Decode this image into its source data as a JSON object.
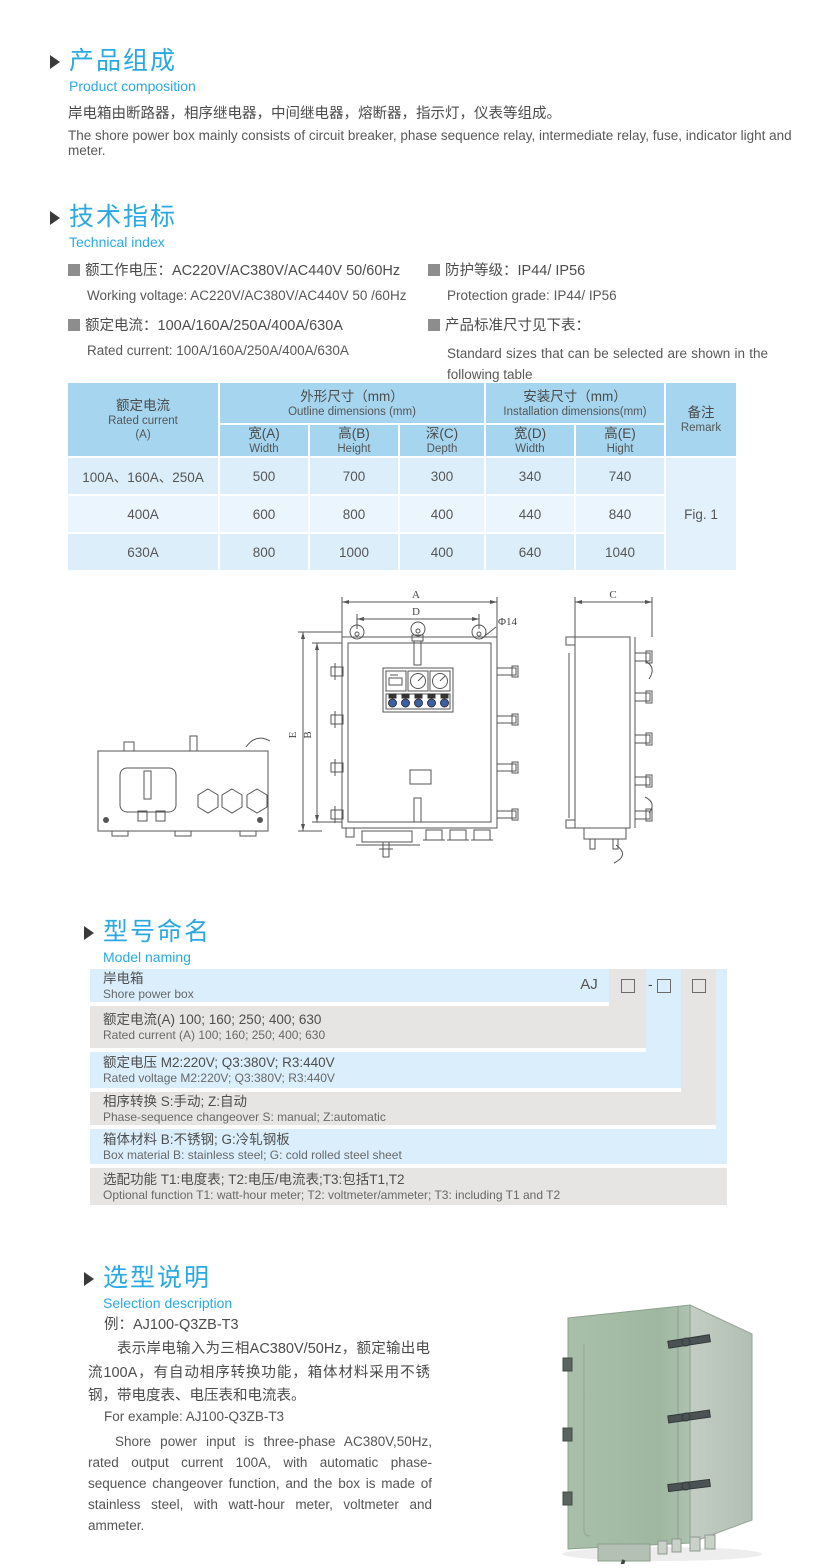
{
  "product_composition": {
    "heading_zh": "产品组成",
    "heading_en": "Product  composition",
    "body_zh": "岸电箱由断路器，相序继电器，中间继电器，熔断器，指示灯，仪表等组成。",
    "body_en": "The shore power box mainly consists of circuit breaker, phase sequence relay, intermediate relay, fuse, indicator light and meter."
  },
  "technical_index": {
    "heading_zh": "技术指标",
    "heading_en": "Technical index",
    "left_items": [
      {
        "zh": "额工作电压：AC220V/AC380V/AC440V  50/60Hz",
        "en": "Working voltage: AC220V/AC380V/AC440V 50 /60Hz"
      },
      {
        "zh": "额定电流：100A/160A/250A/400A/630A",
        "en": "Rated current: 100A/160A/250A/400A/630A"
      }
    ],
    "right_items": [
      {
        "zh": "防护等级：IP44/ IP56",
        "en": "Protection grade: IP44/ IP56"
      },
      {
        "zh": "产品标准尺寸见下表：",
        "en": "Standard sizes that can be selected are shown in the following table"
      }
    ]
  },
  "spec_table": {
    "rated_current_header": {
      "zh": "额定电流",
      "en": "Rated current",
      "unit": "(A)"
    },
    "outline_group": {
      "zh": "外形尺寸（mm）",
      "en": "Outline dimensions (mm)"
    },
    "install_group": {
      "zh": "安装尺寸（mm）",
      "en": "Installation dimensions(mm)"
    },
    "remark_header": {
      "zh": "备注",
      "en": "Remark"
    },
    "sub_headers": [
      {
        "zh": "宽(A)",
        "en": "Width"
      },
      {
        "zh": "高(B)",
        "en": "Height"
      },
      {
        "zh": "深(C)",
        "en": "Depth"
      },
      {
        "zh": "宽(D)",
        "en": "Width"
      },
      {
        "zh": "高(E)",
        "en": "Hight"
      }
    ],
    "rows": [
      {
        "current": "100A、160A、250A",
        "width": "500",
        "height": "700",
        "depth": "300",
        "inst_width": "340",
        "inst_height": "740"
      },
      {
        "current": "400A",
        "width": "600",
        "height": "800",
        "depth": "400",
        "inst_width": "440",
        "inst_height": "840"
      },
      {
        "current": "630A",
        "width": "800",
        "height": "1000",
        "depth": "400",
        "inst_width": "640",
        "inst_height": "1040"
      }
    ],
    "remark_value": "Fig. 1"
  },
  "drawing": {
    "labels": {
      "dim_a": "A",
      "dim_d": "D",
      "hole": "Φ14",
      "dim_e": "E",
      "dim_b": "B",
      "dim_c": "C"
    }
  },
  "model_naming": {
    "heading_zh": "型号命名",
    "heading_en": "Model naming",
    "code_prefix": "AJ",
    "code_dash": "-",
    "rows": [
      {
        "zh": "岸电箱",
        "en": "Shore power box"
      },
      {
        "zh": "额定电流(A)  100; 160; 250; 400; 630",
        "en": "Rated current (A) 100; 160; 250; 400; 630"
      },
      {
        "zh": "额定电压   M2:220V;  Q3:380V;  R3:440V",
        "en": "Rated voltage  M2:220V;  Q3:380V;  R3:440V"
      },
      {
        "zh": "相序转换  S:手动; Z:自动",
        "en": "Phase-sequence changeover  S: manual;  Z:automatic"
      },
      {
        "zh": "箱体材料    B:不锈钢;  G:冷轧钢板",
        "en": "Box material   B: stainless steel; G: cold rolled steel sheet"
      },
      {
        "zh": "选配功能      T1:电度表;  T2:电压/电流表;T3:包括T1,T2",
        "en": "Optional function  T1: watt-hour meter; T2: voltmeter/ammeter; T3: including T1 and T2"
      }
    ]
  },
  "selection": {
    "heading_zh": "选型说明",
    "heading_en": "Selection description",
    "example_zh": "例：AJ100-Q3ZB-T3",
    "body_zh": "表示岸电输入为三相AC380V/50Hz，额定输出电流100A，有自动相序转换功能，箱体材料采用不锈钢，带电度表、电压表和电流表。",
    "example_en": "For example: AJ100-Q3ZB-T3",
    "body_en": "Shore power input is three-phase AC380V,50Hz, rated output current 100A, with automatic phase-sequence changeover function, and the box is made of stainless steel, with watt-hour meter, voltmeter and ammeter."
  }
}
